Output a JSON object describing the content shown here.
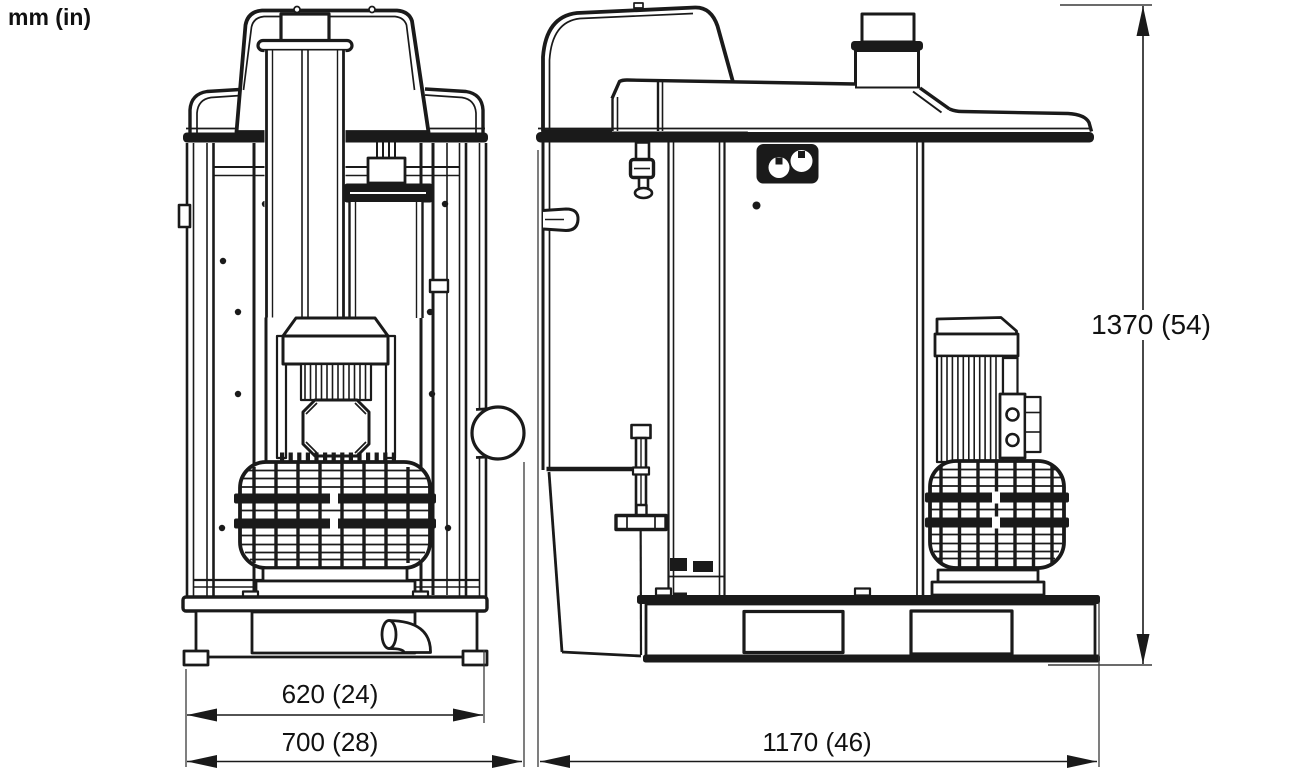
{
  "page": {
    "background_color": "#ffffff",
    "line_color": "#1a1a1a",
    "units_note": "mm (in)"
  },
  "drawing": {
    "subject": "Industrial dust extractor — two-view dimensional line drawing",
    "views": {
      "left": "front view",
      "right": "side view"
    }
  },
  "dimensions": {
    "frame_width": {
      "label": "620 (24)",
      "mm": 620,
      "inches": 24
    },
    "overall_width": {
      "label": "700 (28)",
      "mm": 700,
      "inches": 28
    },
    "overall_depth": {
      "label": "1170 (46)",
      "mm": 1170,
      "inches": 46
    },
    "overall_height": {
      "label": "1370 (54)",
      "mm": 1370,
      "inches": 54
    }
  }
}
